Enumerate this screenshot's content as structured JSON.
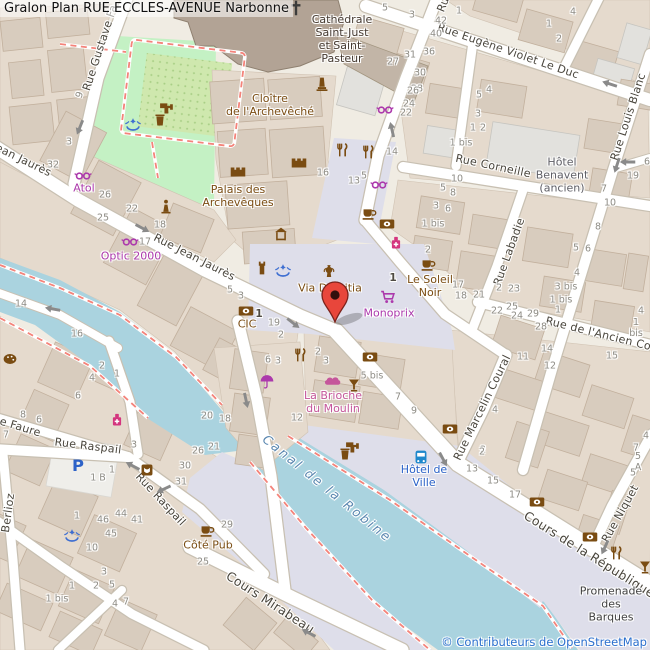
{
  "title": {
    "text": "Gralon Plan RUE ECCLES-AVENUE Narbonne"
  },
  "attribution": {
    "text": "© Contributeurs de OpenStreetMap"
  },
  "colors": {
    "brown": "#7a4c12",
    "purple": "#ac39ac",
    "pink": "#c5569b",
    "blue": "#2b62c8",
    "gray": "#5f5f66",
    "dark": "#453a31",
    "darkgray": "#3f3f3f",
    "water": "#aad3df",
    "water_label": "#5a87b0",
    "attribution_blue": "#2a6fce",
    "marker_red": "#e8463b"
  },
  "map": {
    "streets": [
      {
        "name": "rue-gustave-fabre",
        "text": "Rue Gustave Fa",
        "x": 101,
        "y": 48,
        "rot": -72
      },
      {
        "name": "rue-jean-jaures-west",
        "text": "ean Jaurès",
        "x": 23,
        "y": 161,
        "rot": 26
      },
      {
        "name": "rue-jean-jaures",
        "text": "Rue Jean Jaurès",
        "x": 194,
        "y": 258,
        "rot": 27
      },
      {
        "name": "rue-eugene-violet-le-duc",
        "text": "Rue Eugène Violet Le Duc",
        "x": 508,
        "y": 52,
        "rot": 19
      },
      {
        "name": "rue-louis-blanc",
        "text": "Rue Louis Blanc",
        "x": 629,
        "y": 117,
        "rot": -72
      },
      {
        "name": "rue-corneille",
        "text": "Rue Corneille",
        "x": 493,
        "y": 167,
        "rot": 12
      },
      {
        "name": "rue-labadie",
        "text": "Rue Labadie",
        "x": 510,
        "y": 252,
        "rot": -70
      },
      {
        "name": "rue-de-l-ancien-courrier",
        "text": "Rue de l'Ancien Cour",
        "x": 604,
        "y": 336,
        "rot": 14
      },
      {
        "name": "rue-marcelin-coural",
        "text": "Rue Marcelin Coural",
        "x": 483,
        "y": 408,
        "rot": -64
      },
      {
        "name": "cours-de-la-republique",
        "text": "Cours de la République",
        "x": 589,
        "y": 555,
        "rot": 32,
        "size": 12.5
      },
      {
        "name": "rue-niquet",
        "text": "Rue Niquet",
        "x": 621,
        "y": 514,
        "rot": -61
      },
      {
        "name": "rue-raspail-1",
        "text": "Rue Raspail",
        "x": 88,
        "y": 447,
        "rot": 7
      },
      {
        "name": "rue-raspail-2",
        "text": "Rue Raspail",
        "x": 160,
        "y": 500,
        "rot": 47
      },
      {
        "name": "rue-faure",
        "text": "e Faure",
        "x": 20,
        "y": 428,
        "rot": 17
      },
      {
        "name": "rue-berlioz",
        "text": "Berlioz",
        "x": 9,
        "y": 513,
        "rot": -82
      },
      {
        "name": "cours-mirabeau",
        "text": "Cours Mirabeau",
        "x": 270,
        "y": 603,
        "rot": 33,
        "size": 12.5
      },
      {
        "name": "rue-partial-top",
        "text": "Ru",
        "x": 444,
        "y": 5,
        "rot": -68
      },
      {
        "name": "canal-de-la-robine",
        "text": "Canal de la Robine",
        "x": 327,
        "y": 489,
        "rot": 39,
        "water": true
      }
    ],
    "pois": [
      {
        "name": "cathedrale-saint-just",
        "text": "Cathédrale\nSaint-Just\net Saint-\nPasteur",
        "x": 342,
        "y": 40,
        "color": "dark"
      },
      {
        "name": "cloitre-de-l-archeveche",
        "text": "Cloître\nde l'Archevêché",
        "x": 270,
        "y": 106,
        "color": "brown"
      },
      {
        "name": "palais-des-archeveques",
        "text": "Palais des\nArchevêques",
        "x": 238,
        "y": 197,
        "color": "brown"
      },
      {
        "name": "via-domitia",
        "text": "Via Domitia",
        "x": 330,
        "y": 289,
        "color": "brown"
      },
      {
        "name": "le-soleil-noir",
        "text": "Le Soleil\nNoir",
        "x": 430,
        "y": 287,
        "color": "brown"
      },
      {
        "name": "monoprix",
        "text": "Monoprix",
        "x": 389,
        "y": 314,
        "color": "purple"
      },
      {
        "name": "cic",
        "text": "CIC",
        "x": 247,
        "y": 325,
        "color": "brown"
      },
      {
        "name": "optic-2000",
        "text": "Optic 2000",
        "x": 131,
        "y": 257,
        "color": "purple"
      },
      {
        "name": "atol",
        "text": "Atol",
        "x": 84,
        "y": 189,
        "color": "purple"
      },
      {
        "name": "la-brioche-du-moulin",
        "text": "La Brioche\ndu Moulin",
        "x": 333,
        "y": 403,
        "color": "pink"
      },
      {
        "name": "hotel-benavent",
        "text": "Hôtel\nBenavent\n(ancien)",
        "x": 562,
        "y": 176,
        "color": "gray"
      },
      {
        "name": "hotel-de-ville",
        "text": "Hôtel de\nVille",
        "x": 424,
        "y": 477,
        "color": "blue"
      },
      {
        "name": "cote-pub",
        "text": "Côté Pub",
        "x": 208,
        "y": 546,
        "color": "brown"
      },
      {
        "name": "promenade-des-barques",
        "text": "Promenade\ndes Barques",
        "x": 611,
        "y": 605,
        "color": "darkgray"
      }
    ],
    "house_numbers": [
      {
        "x": 385,
        "y": 8,
        "t": "5"
      },
      {
        "x": 412,
        "y": 15,
        "t": "3"
      },
      {
        "x": 459,
        "y": 11,
        "t": "1"
      },
      {
        "x": 441,
        "y": 21,
        "t": "42"
      },
      {
        "x": 436,
        "y": 34,
        "t": "40"
      },
      {
        "x": 429,
        "y": 52,
        "t": "36"
      },
      {
        "x": 410,
        "y": 55,
        "t": "31"
      },
      {
        "x": 393,
        "y": 62,
        "t": "27"
      },
      {
        "x": 420,
        "y": 73,
        "t": "30"
      },
      {
        "x": 417,
        "y": 89,
        "t": "28"
      },
      {
        "x": 573,
        "y": 12,
        "t": "4"
      },
      {
        "x": 549,
        "y": 24,
        "t": "1"
      },
      {
        "x": 559,
        "y": 39,
        "t": "2"
      },
      {
        "x": 489,
        "y": 90,
        "t": "4"
      },
      {
        "x": 479,
        "y": 95,
        "t": "5"
      },
      {
        "x": 413,
        "y": 91,
        "t": "26"
      },
      {
        "x": 409,
        "y": 104,
        "t": "24"
      },
      {
        "x": 406,
        "y": 113,
        "t": "22"
      },
      {
        "x": 392,
        "y": 152,
        "t": "14"
      },
      {
        "x": 364,
        "y": 176,
        "t": "5"
      },
      {
        "x": 354,
        "y": 181,
        "t": "13"
      },
      {
        "x": 323,
        "y": 173,
        "t": "16"
      },
      {
        "x": 478,
        "y": 114,
        "t": "3"
      },
      {
        "x": 473,
        "y": 128,
        "t": "1"
      },
      {
        "x": 483,
        "y": 128,
        "t": "2"
      },
      {
        "x": 461,
        "y": 143,
        "t": "1 bis"
      },
      {
        "x": 457,
        "y": 179,
        "t": "10"
      },
      {
        "x": 443,
        "y": 188,
        "t": "5"
      },
      {
        "x": 453,
        "y": 193,
        "t": "8"
      },
      {
        "x": 436,
        "y": 206,
        "t": "3"
      },
      {
        "x": 448,
        "y": 209,
        "t": "6"
      },
      {
        "x": 633,
        "y": 176,
        "t": "19"
      },
      {
        "x": 604,
        "y": 189,
        "t": "7"
      },
      {
        "x": 610,
        "y": 203,
        "t": "10"
      },
      {
        "x": 598,
        "y": 227,
        "t": "8"
      },
      {
        "x": 576,
        "y": 248,
        "t": "5"
      },
      {
        "x": 588,
        "y": 249,
        "t": "6"
      },
      {
        "x": 647,
        "y": 162,
        "t": "6"
      },
      {
        "x": 80,
        "y": 95,
        "t": "9",
        "r": -70
      },
      {
        "x": 69,
        "y": 142,
        "t": "3"
      },
      {
        "x": 53,
        "y": 165,
        "t": "32"
      },
      {
        "x": 105,
        "y": 195,
        "t": "26"
      },
      {
        "x": 132,
        "y": 209,
        "t": "22"
      },
      {
        "x": 103,
        "y": 218,
        "t": "25"
      },
      {
        "x": 160,
        "y": 225,
        "t": "18"
      },
      {
        "x": 145,
        "y": 242,
        "t": "17"
      },
      {
        "x": 230,
        "y": 290,
        "t": "5"
      },
      {
        "x": 241,
        "y": 296,
        "t": "3"
      },
      {
        "x": 259,
        "y": 314,
        "t": "1",
        "b": 1
      },
      {
        "x": 274,
        "y": 323,
        "t": "19"
      },
      {
        "x": 281,
        "y": 335,
        "t": "2"
      },
      {
        "x": 268,
        "y": 360,
        "t": "6"
      },
      {
        "x": 278,
        "y": 361,
        "t": "3"
      },
      {
        "x": 318,
        "y": 352,
        "t": "2"
      },
      {
        "x": 326,
        "y": 361,
        "t": "3"
      },
      {
        "x": 297,
        "y": 418,
        "t": "12"
      },
      {
        "x": 207,
        "y": 416,
        "t": "20"
      },
      {
        "x": 225,
        "y": 419,
        "t": "18"
      },
      {
        "x": 372,
        "y": 376,
        "t": "5 bis"
      },
      {
        "x": 433,
        "y": 224,
        "t": "1 bis"
      },
      {
        "x": 428,
        "y": 250,
        "t": "2"
      },
      {
        "x": 393,
        "y": 278,
        "t": "1",
        "b": 1
      },
      {
        "x": 458,
        "y": 285,
        "t": "17"
      },
      {
        "x": 461,
        "y": 296,
        "t": "18"
      },
      {
        "x": 479,
        "y": 295,
        "t": "21"
      },
      {
        "x": 499,
        "y": 288,
        "t": "2"
      },
      {
        "x": 514,
        "y": 289,
        "t": "23"
      },
      {
        "x": 497,
        "y": 311,
        "t": "22"
      },
      {
        "x": 512,
        "y": 307,
        "t": "25"
      },
      {
        "x": 517,
        "y": 316,
        "t": "24"
      },
      {
        "x": 577,
        "y": 273,
        "t": "4"
      },
      {
        "x": 566,
        "y": 287,
        "t": "3 bis"
      },
      {
        "x": 561,
        "y": 300,
        "t": "1 bis"
      },
      {
        "x": 558,
        "y": 310,
        "t": "1"
      },
      {
        "x": 641,
        "y": 311,
        "t": "4"
      },
      {
        "x": 636,
        "y": 328,
        "t": "1 bis"
      },
      {
        "x": 533,
        "y": 314,
        "t": "29"
      },
      {
        "x": 541,
        "y": 327,
        "t": "28"
      },
      {
        "x": 547,
        "y": 349,
        "t": "14"
      },
      {
        "x": 523,
        "y": 357,
        "t": "11"
      },
      {
        "x": 612,
        "y": 356,
        "t": "15"
      },
      {
        "x": 550,
        "y": 366,
        "t": "12"
      },
      {
        "x": 398,
        "y": 397,
        "t": "7"
      },
      {
        "x": 414,
        "y": 411,
        "t": "9"
      },
      {
        "x": 495,
        "y": 410,
        "t": "4"
      },
      {
        "x": 483,
        "y": 450,
        "t": "2"
      },
      {
        "x": 21,
        "y": 304,
        "t": "14"
      },
      {
        "x": 77,
        "y": 334,
        "t": "16"
      },
      {
        "x": 102,
        "y": 366,
        "t": "2"
      },
      {
        "x": 117,
        "y": 374,
        "t": "1"
      },
      {
        "x": 92,
        "y": 378,
        "t": "4"
      },
      {
        "x": 78,
        "y": 396,
        "t": "6"
      },
      {
        "x": 23,
        "y": 415,
        "t": "8"
      },
      {
        "x": 39,
        "y": 420,
        "t": "6"
      },
      {
        "x": 6,
        "y": 435,
        "t": "7"
      },
      {
        "x": 134,
        "y": 445,
        "t": "3"
      },
      {
        "x": 198,
        "y": 451,
        "t": "26"
      },
      {
        "x": 214,
        "y": 447,
        "t": "21"
      },
      {
        "x": 185,
        "y": 466,
        "t": "30"
      },
      {
        "x": 181,
        "y": 482,
        "t": "31"
      },
      {
        "x": 112,
        "y": 470,
        "t": "1"
      },
      {
        "x": 98,
        "y": 478,
        "t": "1 B"
      },
      {
        "x": 77,
        "y": 516,
        "t": "1"
      },
      {
        "x": 103,
        "y": 520,
        "t": "46"
      },
      {
        "x": 121,
        "y": 514,
        "t": "44"
      },
      {
        "x": 137,
        "y": 520,
        "t": "41"
      },
      {
        "x": 111,
        "y": 534,
        "t": "45"
      },
      {
        "x": 92,
        "y": 548,
        "t": "10"
      },
      {
        "x": 227,
        "y": 525,
        "t": "29"
      },
      {
        "x": 203,
        "y": 562,
        "t": "25"
      },
      {
        "x": 104,
        "y": 572,
        "t": "3"
      },
      {
        "x": 96,
        "y": 586,
        "t": "2"
      },
      {
        "x": 112,
        "y": 585,
        "t": "5"
      },
      {
        "x": 72,
        "y": 586,
        "t": "1"
      },
      {
        "x": 115,
        "y": 604,
        "t": "4"
      },
      {
        "x": 126,
        "y": 602,
        "t": "7"
      },
      {
        "x": 57,
        "y": 599,
        "t": "1 bis"
      },
      {
        "x": 482,
        "y": 452,
        "t": "2"
      },
      {
        "x": 472,
        "y": 469,
        "t": "13"
      },
      {
        "x": 493,
        "y": 481,
        "t": "15"
      },
      {
        "x": 515,
        "y": 495,
        "t": "17"
      },
      {
        "x": 646,
        "y": 436,
        "t": "4"
      },
      {
        "x": 636,
        "y": 448,
        "t": "7"
      },
      {
        "x": 638,
        "y": 462,
        "t": "5 A"
      },
      {
        "x": 633,
        "y": 473,
        "t": "5"
      }
    ],
    "icons": [
      {
        "type": "cross",
        "x": 296,
        "y": 8,
        "name": "cathedral-cross"
      },
      {
        "type": "monument",
        "x": 322,
        "y": 84,
        "name": "cloister-monument"
      },
      {
        "type": "castle",
        "x": 238,
        "y": 172,
        "name": "castle"
      },
      {
        "type": "castle",
        "x": 299,
        "y": 163,
        "name": "castle"
      },
      {
        "type": "fort",
        "x": 281,
        "y": 234,
        "name": "fort"
      },
      {
        "type": "tower",
        "x": 262,
        "y": 268,
        "name": "city-wall-tower"
      },
      {
        "type": "fountain",
        "x": 133,
        "y": 125,
        "name": "park-fountain"
      },
      {
        "type": "fountain",
        "x": 283,
        "y": 271,
        "name": "plaza-fountain"
      },
      {
        "type": "fountain",
        "x": 72,
        "y": 536,
        "name": "fountain"
      },
      {
        "type": "amphora",
        "x": 329,
        "y": 272,
        "name": "via-domitia-archaeological"
      },
      {
        "type": "statue",
        "x": 166,
        "y": 206,
        "name": "statue"
      },
      {
        "type": "waste",
        "x": 160,
        "y": 120,
        "name": "waste-basket"
      },
      {
        "type": "waste",
        "x": 345,
        "y": 454,
        "name": "waste-basket"
      },
      {
        "type": "tap",
        "x": 166,
        "y": 107,
        "name": "drinking-water"
      },
      {
        "type": "tap",
        "x": 352,
        "y": 446,
        "name": "drinking-water"
      },
      {
        "type": "bank",
        "x": 246,
        "y": 311,
        "name": "cic-bank"
      },
      {
        "type": "bank",
        "x": 387,
        "y": 224,
        "name": "bank"
      },
      {
        "type": "bank",
        "x": 370,
        "y": 357,
        "name": "bank"
      },
      {
        "type": "bank",
        "x": 450,
        "y": 429,
        "name": "bank"
      },
      {
        "type": "bank",
        "x": 537,
        "y": 502,
        "name": "bank"
      },
      {
        "type": "bank",
        "x": 590,
        "y": 537,
        "name": "bank"
      },
      {
        "type": "cafe",
        "x": 369,
        "y": 213,
        "name": "cafe"
      },
      {
        "type": "cafe",
        "x": 428,
        "y": 264,
        "name": "le-soleil-noir-cafe"
      },
      {
        "type": "cafe",
        "x": 207,
        "y": 530,
        "name": "cote-pub-cafe"
      },
      {
        "type": "restaurant",
        "x": 342,
        "y": 150,
        "name": "restaurant"
      },
      {
        "type": "restaurant",
        "x": 368,
        "y": 152,
        "name": "restaurant"
      },
      {
        "type": "restaurant",
        "x": 300,
        "y": 355,
        "name": "restaurant"
      },
      {
        "type": "restaurant",
        "x": 616,
        "y": 553,
        "name": "restaurant"
      },
      {
        "type": "cocktail",
        "x": 354,
        "y": 385,
        "name": "bar"
      },
      {
        "type": "cocktail",
        "x": 645,
        "y": 567,
        "name": "bar"
      },
      {
        "type": "glasses",
        "x": 83,
        "y": 176,
        "name": "atol-optician"
      },
      {
        "type": "glasses",
        "x": 130,
        "y": 242,
        "name": "optic-2000-optician"
      },
      {
        "type": "glasses",
        "x": 385,
        "y": 110,
        "name": "optician"
      },
      {
        "type": "glasses",
        "x": 379,
        "y": 185,
        "name": "optician"
      },
      {
        "type": "cart",
        "x": 388,
        "y": 297,
        "name": "monoprix-supermarket"
      },
      {
        "type": "bread",
        "x": 333,
        "y": 382,
        "name": "bakery"
      },
      {
        "type": "pharmacy",
        "x": 396,
        "y": 243,
        "name": "pharmacy"
      },
      {
        "type": "pharmacy",
        "x": 117,
        "y": 420,
        "name": "pharmacy"
      },
      {
        "type": "umbrella",
        "x": 267,
        "y": 381,
        "name": "umbrella-shop"
      },
      {
        "type": "bus",
        "x": 421,
        "y": 457,
        "name": "bus-stop"
      },
      {
        "type": "parking",
        "x": 78,
        "y": 465,
        "name": "parking"
      },
      {
        "type": "palette",
        "x": 10,
        "y": 359,
        "name": "art-gallery"
      },
      {
        "type": "theater",
        "x": 147,
        "y": 470,
        "name": "theater"
      }
    ],
    "arrows": [
      {
        "x": 80,
        "y": 127,
        "rot": 112
      },
      {
        "x": 142,
        "y": 228,
        "rot": 28
      },
      {
        "x": 392,
        "y": 130,
        "rot": -103
      },
      {
        "x": 610,
        "y": 84,
        "rot": 198
      },
      {
        "x": 617,
        "y": 165,
        "rot": 108
      },
      {
        "x": 628,
        "y": 162,
        "rot": 180
      },
      {
        "x": 293,
        "y": 323,
        "rot": 38
      },
      {
        "x": 246,
        "y": 400,
        "rot": 78
      },
      {
        "x": 443,
        "y": 459,
        "rot": 62
      },
      {
        "x": 133,
        "y": 466,
        "rot": 208
      },
      {
        "x": 164,
        "y": 489,
        "rot": 155
      },
      {
        "x": 309,
        "y": 633,
        "rot": 207
      },
      {
        "x": 605,
        "y": 547,
        "rot": 115
      },
      {
        "x": 53,
        "y": 309,
        "rot": 190
      }
    ]
  }
}
